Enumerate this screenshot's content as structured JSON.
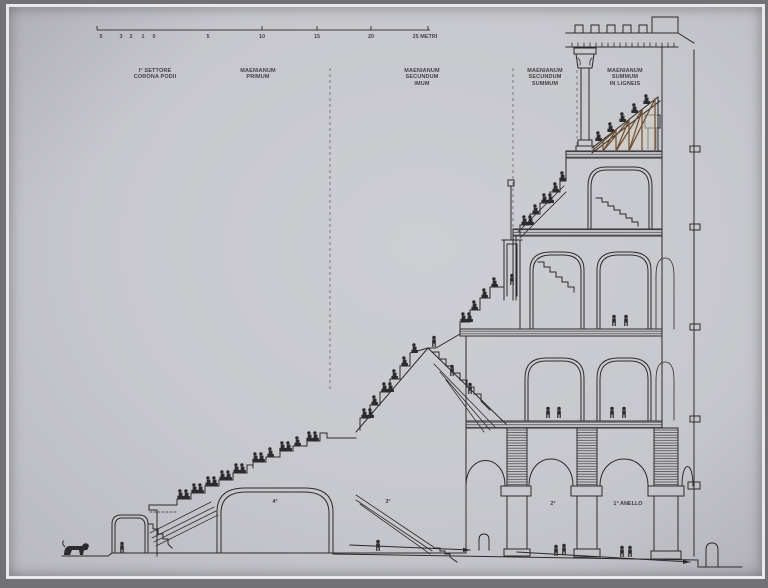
{
  "panel": {
    "description_colors": {
      "background": "#c7c8cd",
      "line": "#2b2a2e",
      "wood": "#6d4c31"
    }
  },
  "scale_bar": {
    "ticks": [
      "5",
      "3",
      "2",
      "1",
      "0",
      "5",
      "10",
      "15",
      "20",
      "25 METRI"
    ]
  },
  "zones": [
    {
      "label": "I° SETTORE\nCORONA PODII"
    },
    {
      "label": "MAENIANUM\nPRIMUM"
    },
    {
      "label": "MAENIANUM\nSECUNDUM\nIMUM"
    },
    {
      "label": "MAENIANUM\nSECUNDUM\nSUMMUM"
    },
    {
      "label": "MAENIANUM\nSUMMUM\nIN LIGNEIS"
    }
  ],
  "rings": [
    {
      "label": "4°"
    },
    {
      "label": "3°"
    },
    {
      "label": "2°"
    },
    {
      "label": "1° ANELLO"
    }
  ]
}
